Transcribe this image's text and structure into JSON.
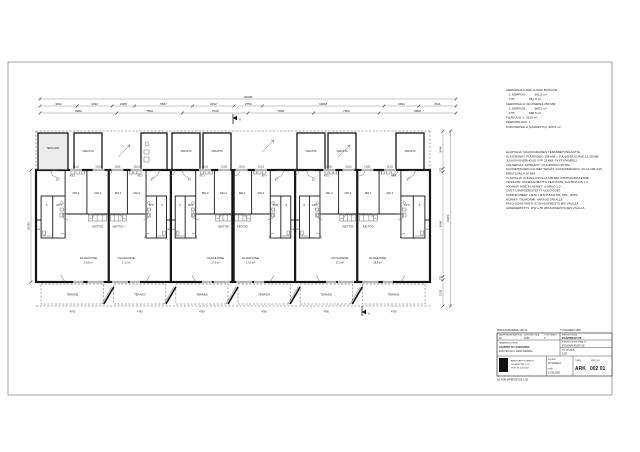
{
  "page": {
    "background": "#ffffff",
    "line_color": "#1a1a1a"
  },
  "dimensions": {
    "overall_top": "42096",
    "row1": [
      "3611",
      "3394",
      "2188",
      "5637",
      "4032",
      "2750",
      "11818",
      "3394",
      "3611"
    ],
    "row2": [
      "8900",
      "7600",
      "7600",
      "7600",
      "7600",
      "8900"
    ],
    "left_dim": "10035",
    "right_segments": [
      "3048",
      "275",
      "8548",
      "275",
      "2135"
    ],
    "right_overall": "14281",
    "terrace_dim": "4790"
  },
  "plan": {
    "section_mark": "A",
    "storage_label": "VARASTO",
    "tech_label": "TEKN./VAR.",
    "terrace_label": "TERASSI",
    "window_labels": [
      "12x21",
      "21x21"
    ],
    "units": [
      {
        "id": "AS 1",
        "bed1": "MH 1",
        "bed2": "MH 2",
        "bath": "KPH",
        "sauna": "S",
        "closet": "VH",
        "hall": "ET",
        "kitchen": "KEITTIÖ",
        "living": "OLOHUONE",
        "living_area": "19,5 m²"
      },
      {
        "id": "AS 2",
        "bed1": "MH 1",
        "bed2": "MH 2",
        "bath": "KPH",
        "sauna": "S",
        "closet": "VH",
        "hall": "ET",
        "kitchen": "KEITTIÖ",
        "living": "OLOHUONE",
        "living_area": "17,0 m²"
      },
      {
        "id": "AS 3",
        "bed1": "MH 1",
        "bed2": "MH 2",
        "bath": "KPH",
        "sauna": "S",
        "closet": "VH",
        "hall": "ET",
        "kitchen": "KEITTIÖ",
        "living": "OLOHUONE",
        "living_area": "17,0 m²"
      },
      {
        "id": "AS 4",
        "bed1": "MH 1",
        "bed2": "MH 2",
        "bath": "KPH",
        "sauna": "S",
        "closet": "VH",
        "hall": "ET",
        "kitchen": "KEITTIÖ",
        "living": "OLOHUONE",
        "living_area": "17,0 m²"
      },
      {
        "id": "AS 5",
        "bed1": "MH 1",
        "bed2": "MH 2",
        "bath": "KPH",
        "sauna": "S",
        "closet": "VH",
        "hall": "ET",
        "kitchen": "KEITTIÖ",
        "living": "OLOHUONE",
        "living_area": "17,0 m²"
      },
      {
        "id": "AS 6",
        "bed1": "MH 1",
        "bed2": "MH 2",
        "bath": "KPH",
        "sauna": "S",
        "closet": "VH",
        "hall": "ET",
        "kitchen": "KEITTIÖ",
        "living": "OLOHUONE",
        "living_area": "19,5 m²"
      }
    ]
  },
  "area_summary": {
    "lines": [
      "KERROSALA RAK.LUVAN MUKAAN",
      "   1. KERROS           561,5 m²",
      "   YHT.                561,5 m²",
      "KERROSALA ULKOSEINÄ 250 MM",
      "   1. KERROS           585,5 m²",
      "   YHT.                585,5 m²",
      "TILAVUUS  n. 2615 m³",
      "KERROSLUKU  1",
      "KOKONAISALA (LASKETTU)  625,0 m²"
    ]
  },
  "notes": {
    "lines": [
      "ALAPOHJA: MAANVARAINEN TERÄSBETONILAATTA",
      "ULKOSEINÄT: PUURUNKO 198 MM + TUULENSUOJAVILLA 30 MM,",
      "JULKISIVUVERHOUS UYP 23 MM, PYSTYPANEELI",
      "VÄLISEINÄT: KIPSILEVY / PUURUNKO 66 MM",
      "HUONEISTOJEN VÄLISET SEINÄT: KAKSOISRUNKO, VILLA 125+125,",
      "ERISTEVILLA 50 MM",
      "YLÄPOHJA: PUHALLUSVILLA 500 MM, RISTIKKORAKENNE",
      "VESIKATE: KONESAUMATTU PELTIKATE, KALTEVUUS 1:3",
      "IKKUNAT: MSE 3-LASISET, U-ARVO 1,0",
      "OVET: LÄMPÖERISTETYT ULKO-OVET",
      "KODINKONEET: LIESI, LIESITUULETIN, APK, JK/PK",
      "HORMIT: TIILIHORMI, VARAUS TAKALLE",
      "PALO-OSASTOINTI: EI 30 HUONEISTOJEN VÄLILLÄ",
      "ÄÄNENERISTYS: R'W ≥ 55 dB HUONEISTOJEN VÄLILLÄ"
    ]
  },
  "title_block": {
    "above_left": "PIIRUSTUSNUMERO  002 01",
    "above_right": "TYÖNUMERO  2096",
    "left": {
      "col1_label": "KAUPUNGINOSA/KYLÄ",
      "col1_value": "12",
      "col2_label": "KORTTELI/TILA",
      "col2_value": "1046",
      "col3_label": "TONTTI/RN:O",
      "col3_value": "3",
      "building_label": "RAKENNUSKOHDE",
      "building_name": "ASUNTO OY KOIVURIVI",
      "building_address": "KOIVUKUJA 3, 04200 KERAVA"
    },
    "right": {
      "row1_label": "PIIRUSTUSLAJI",
      "row1_value": "PÄÄPIIRUSTUS",
      "row2_label": "PIIRUSTUKSEN SISÄLTÖ",
      "row2_value": "POHJAPIIRUSTUS",
      "scale_label": "MITTAKAAVA",
      "scale_value": "1:50"
    },
    "bottom": {
      "firm_line1": "ARKKITEHTITOIMISTO",
      "firm_line2": "SUUNNITTELU OY",
      "firm_line3": "PUH. 09 123 4567",
      "sign_label": "SUUNN.",
      "sign_value": "M. MÄKELÄ",
      "date_label": "PVM",
      "date_value": "12.05.2020",
      "disc_label": "TUNN.",
      "num_label": "PIIR. N:O",
      "discipline": "ARK",
      "number": "002 01"
    },
    "below": "A3  POHJAPIIRUSTUS 1:50"
  }
}
